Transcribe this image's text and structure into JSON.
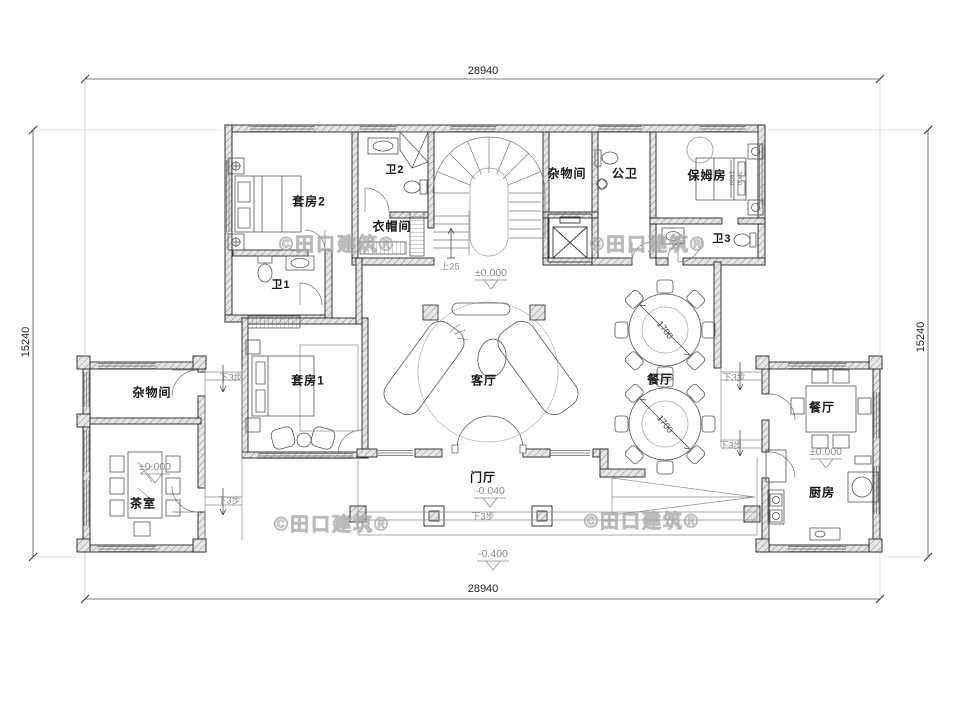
{
  "drawing": {
    "dim_width_top": "28940",
    "dim_width_bottom": "28940",
    "dim_height_left": "15240",
    "dim_height_right": "15240"
  },
  "rooms": {
    "suite2": "套房2",
    "bath2": "卫2",
    "cloakroom": "衣帽间",
    "storage_top": "杂物间",
    "public_bath": "公卫",
    "nanny_room": "保姆房",
    "bath3": "卫3",
    "bath1": "卫1",
    "living_room": "客厅",
    "dining_main": "餐厅",
    "suite1": "套房1",
    "storage_left": "杂物间",
    "tea_room": "茶室",
    "foyer": "门厅",
    "dining_right": "餐厅",
    "kitchen": "厨房"
  },
  "levels": {
    "ground": "±0.000",
    "foyer": "-0.040",
    "terrace": "-0.400"
  },
  "notes": {
    "stair_up": "上25",
    "steps_down": "下3步"
  },
  "furniture_dims": {
    "round_table": "1700",
    "bed_width": "1800",
    "bed_length": "2000"
  },
  "watermark": "©田口建筑®",
  "colors": {
    "line": "#2a2a2a",
    "light_line": "#9a9a9a",
    "wall_hatch": "#8a8a8a",
    "watermark": "#c4c4c4",
    "background": "#ffffff"
  }
}
